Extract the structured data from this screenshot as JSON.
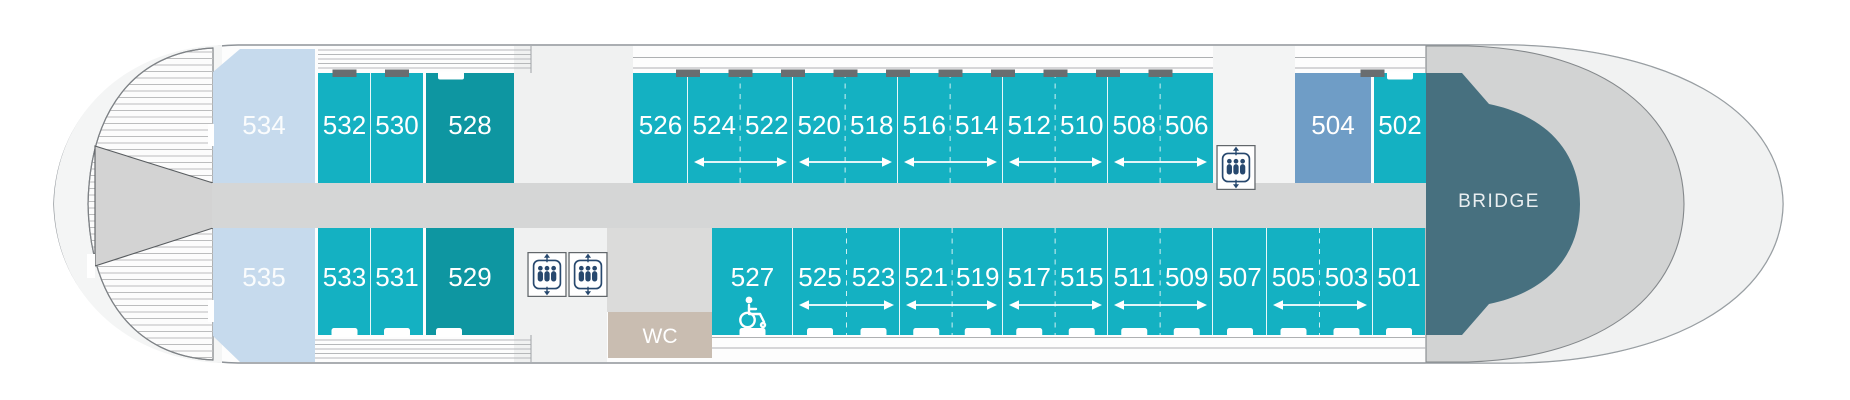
{
  "deck_plan": {
    "ship_sections": {
      "bridge": {
        "label": "BRIDGE"
      },
      "wc": {
        "label": "WC"
      }
    },
    "colors": {
      "cabin_standard": "#14b1c2",
      "cabin_dark": "#0e96a1",
      "cabin_light_blue": "#c6daed",
      "cabin_steel_blue": "#6f9dc6",
      "bridge": "#47707f",
      "corridor": "#d5d6d6",
      "wc": "#c9bdb1",
      "elevator_icon": "#27486e",
      "open_deck_stripe": "#bcbdbe",
      "label_text": "#ffffff"
    },
    "cabins_top_row": [
      {
        "label": "534",
        "x": 213,
        "w": 102,
        "type": "light_blue",
        "shape": "bow_pentagon_top"
      },
      {
        "label": "532",
        "x": 318,
        "w": 53,
        "type": "standard"
      },
      {
        "label": "530",
        "x": 371,
        "w": 52,
        "type": "standard"
      },
      {
        "label": "528",
        "x": 426,
        "w": 88,
        "type": "dark"
      },
      {
        "label": "526",
        "x": 633,
        "w": 55,
        "type": "standard"
      },
      {
        "label": "524",
        "x": 688,
        "w": 52.5,
        "type": "standard",
        "dashed_right": true
      },
      {
        "label": "522",
        "x": 740.5,
        "w": 52.5,
        "type": "standard"
      },
      {
        "label": "520",
        "x": 793,
        "w": 52.5,
        "type": "standard",
        "dashed_right": true
      },
      {
        "label": "518",
        "x": 845.5,
        "w": 52.5,
        "type": "standard"
      },
      {
        "label": "516",
        "x": 898,
        "w": 52.5,
        "type": "standard",
        "dashed_right": true
      },
      {
        "label": "514",
        "x": 950.5,
        "w": 52.5,
        "type": "standard"
      },
      {
        "label": "512",
        "x": 1003,
        "w": 52.5,
        "type": "standard",
        "dashed_right": true
      },
      {
        "label": "510",
        "x": 1055.5,
        "w": 52.5,
        "type": "standard"
      },
      {
        "label": "508",
        "x": 1108,
        "w": 52.5,
        "type": "standard",
        "dashed_right": true
      },
      {
        "label": "506",
        "x": 1160.5,
        "w": 52.5,
        "type": "standard"
      },
      {
        "label": "504",
        "x": 1295,
        "w": 76,
        "type": "steel_blue"
      },
      {
        "label": "502",
        "x": 1374,
        "w": 52,
        "type": "standard"
      }
    ],
    "cabins_bottom_row": [
      {
        "label": "535",
        "x": 213,
        "w": 102,
        "type": "light_blue",
        "shape": "bow_pentagon_bottom"
      },
      {
        "label": "533",
        "x": 318,
        "w": 53,
        "type": "standard"
      },
      {
        "label": "531",
        "x": 371,
        "w": 52,
        "type": "standard"
      },
      {
        "label": "529",
        "x": 426,
        "w": 88,
        "type": "dark"
      },
      {
        "label": "527",
        "x": 712,
        "w": 81,
        "type": "standard",
        "wheelchair": true
      },
      {
        "label": "525",
        "x": 793,
        "w": 54,
        "type": "standard",
        "dashed_right": true
      },
      {
        "label": "523",
        "x": 847,
        "w": 53,
        "type": "standard"
      },
      {
        "label": "521",
        "x": 900,
        "w": 52.5,
        "type": "standard",
        "dashed_right": true
      },
      {
        "label": "519",
        "x": 952.5,
        "w": 50.5,
        "type": "standard"
      },
      {
        "label": "517",
        "x": 1003,
        "w": 52.5,
        "type": "standard",
        "dashed_right": true
      },
      {
        "label": "515",
        "x": 1055.5,
        "w": 52.5,
        "type": "standard"
      },
      {
        "label": "511",
        "x": 1108,
        "w": 52.5,
        "type": "standard",
        "dashed_right": true
      },
      {
        "label": "509",
        "x": 1160.5,
        "w": 52.5,
        "type": "standard"
      },
      {
        "label": "507",
        "x": 1213,
        "w": 54,
        "type": "standard"
      },
      {
        "label": "505",
        "x": 1267,
        "w": 53,
        "type": "standard",
        "dashed_right": true
      },
      {
        "label": "503",
        "x": 1320,
        "w": 53,
        "type": "standard"
      },
      {
        "label": "501",
        "x": 1373,
        "w": 52,
        "type": "standard"
      }
    ],
    "connecting_pairs_top": [
      [
        "524",
        "522"
      ],
      [
        "520",
        "518"
      ],
      [
        "516",
        "514"
      ],
      [
        "512",
        "510"
      ],
      [
        "508",
        "506"
      ]
    ],
    "connecting_pairs_bottom": [
      [
        "525",
        "523"
      ],
      [
        "521",
        "519"
      ],
      [
        "517",
        "515"
      ],
      [
        "511",
        "509"
      ],
      [
        "505",
        "503"
      ]
    ],
    "facilities": {
      "elevator_icons": 3,
      "wheelchair_accessible_cabin": "527",
      "wc_room": "WC"
    }
  }
}
